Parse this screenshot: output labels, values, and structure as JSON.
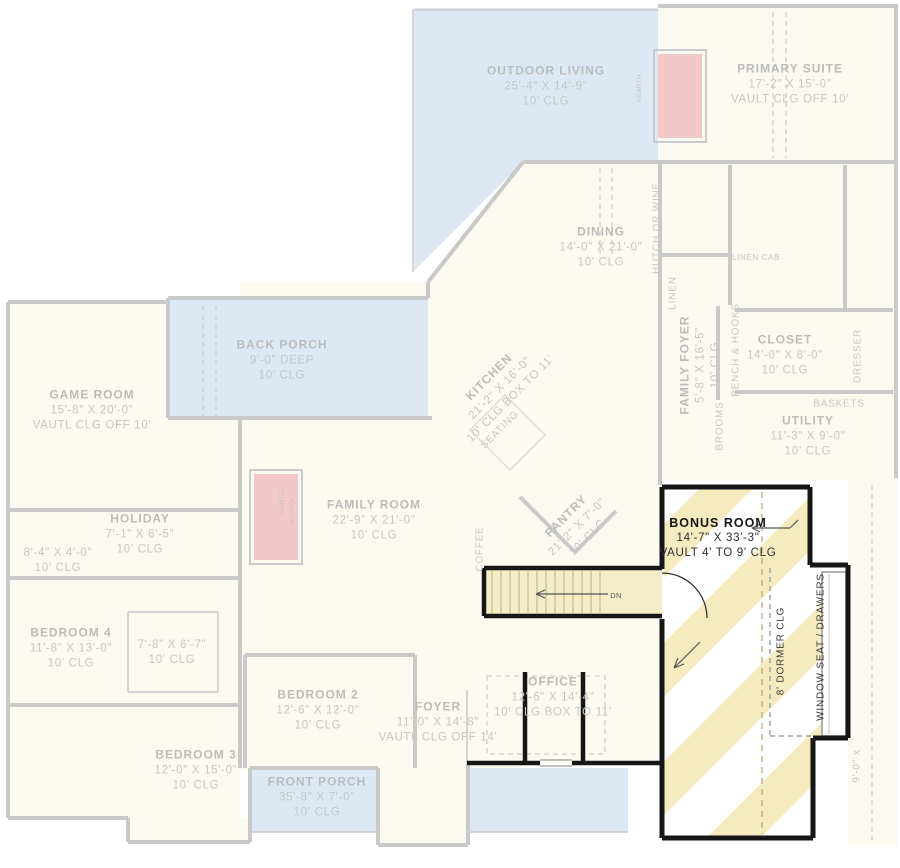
{
  "document": {
    "type": "architectural-floor-plan",
    "highlight": "BONUS ROOM over stairs"
  },
  "colors": {
    "porch_blue": "#dce9f5",
    "house_fill": "#fcfaf1",
    "faded_wall": "#c9c9c9",
    "highlight_wall": "#161616",
    "stripe_yellow": "#f6ebbf",
    "stair_fill": "#f5edc8",
    "fireplace_pink": "#f5c8c8",
    "faded_text": "#c6c6c6",
    "highlight_text": "#2e2e2e"
  },
  "rooms": {
    "outdoor_living": {
      "name": "OUTDOOR LIVING",
      "dims": "25'-4\" X 14'-9\"",
      "clg": "10' CLG"
    },
    "primary_suite": {
      "name": "PRIMARY SUITE",
      "dims": "17'-2\" X 15'-0\"",
      "clg": "VAULT CLG OFF 10'"
    },
    "dining": {
      "name": "DINING",
      "dims": "14'-0\" X 21'-0\"",
      "clg": "10' CLG"
    },
    "back_porch": {
      "name": "BACK PORCH",
      "dims": "9'-0\" DEEP",
      "clg": "10' CLG"
    },
    "game_room": {
      "name": "GAME ROOM",
      "dims": "15'-8\" X 20'-0\"",
      "clg": "VAUTL CLG OFF 10'"
    },
    "kitchen": {
      "name": "KITCHEN",
      "dims": "21'-2\" X 16'-0\"",
      "clg": "10' CLG BOX TO 11'"
    },
    "family_foyer": {
      "name": "FAMILY FOYER",
      "dims": "5'-8\" X 16'-5\"",
      "clg": "10' CLG"
    },
    "closet": {
      "name": "CLOSET",
      "dims": "14'-0\" X 8'-0\"",
      "clg": "10' CLG"
    },
    "utility": {
      "name": "UTILITY",
      "dims": "11'-3\" X 9'-0\"",
      "clg": "10' CLG"
    },
    "family_room": {
      "name": "FAMILY ROOM",
      "dims": "22'-9\" X 21'-0\"",
      "clg": "10' CLG"
    },
    "holiday": {
      "name": "HOLIDAY",
      "dims": "7'-1\" X 6'-5\"",
      "clg": "10' CLG"
    },
    "holiday_closet": {
      "dims": "8'-4\" X 4'-0\"",
      "clg": "10' CLG"
    },
    "bedroom_4": {
      "name": "BEDROOM 4",
      "dims": "11'-8\" X 13'-0\"",
      "clg": "10' CLG"
    },
    "bedroom_4_closet": {
      "dims": "7'-8\" X 6'-7\"",
      "clg": "10' CLG"
    },
    "bedroom_2": {
      "name": "BEDROOM 2",
      "dims": "12'-6\" X 12'-0\"",
      "clg": "10' CLG"
    },
    "bedroom_3": {
      "name": "BEDROOM 3",
      "dims": "12'-0\" X 15'-0\"",
      "clg": "10' CLG"
    },
    "foyer": {
      "name": "FOYER",
      "dims": "11'-0\" X 14'-8\"",
      "clg": "VAUTL CLG OFF 14'"
    },
    "front_porch": {
      "name": "FRONT PORCH",
      "dims": "35'-8\" X 7'-0\"",
      "clg": "10' CLG"
    },
    "office": {
      "name": "OFFICE",
      "dims": "12'-6\" X 14'-4\"",
      "clg": "10' CLG BOX TO 11'"
    },
    "pantry": {
      "name": "PANTRY",
      "dims": "21'-2\" X 7'-0\"",
      "clg": "10' CLG"
    },
    "bonus_room": {
      "name": "BONUS ROOM",
      "dims": "14'-7\" X 33'-3\"",
      "clg": "VAULT 4' TO 9' CLG"
    }
  },
  "annotations": {
    "hutch_or_wine": "HUTCH OR WINE",
    "linen": "LINEN",
    "linen_cab": "LINEN CAB",
    "bench_hooks": "BENCH & HOOKS",
    "brooms": "BROOMS",
    "dresser": "DRESSER",
    "baskets": "BASKETS",
    "seating": "SEATING",
    "coffee": "COFFEE",
    "hearth": "HEARTH",
    "mantle": "MANTLE",
    "dn": "DN",
    "dormer_clg": "8' DORMER CLG",
    "window_seat": "WINDOW SEAT / DRAWERS",
    "garage_dim": "9'-0\" x"
  }
}
